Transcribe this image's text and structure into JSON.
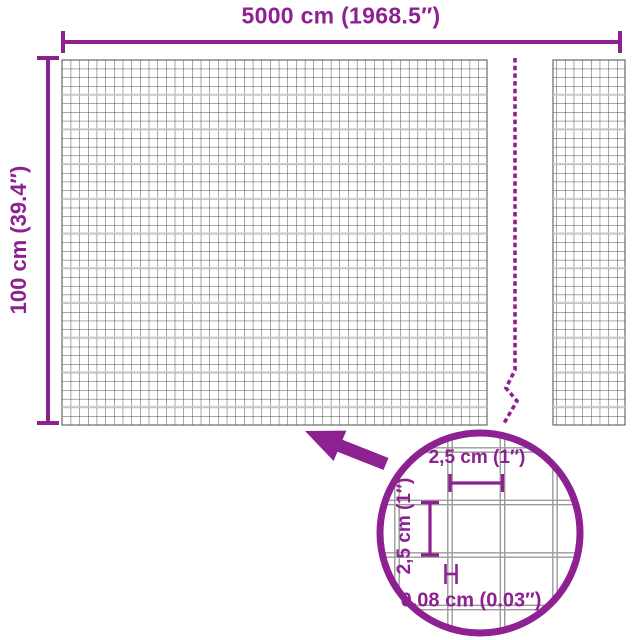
{
  "title": "Wire mesh panel dimensions diagram",
  "colors": {
    "accent_purple": "#8e2192",
    "mesh_line": "#4d4d4d",
    "wire_gray": "#9a9a9a",
    "background": "#ffffff"
  },
  "dimensions": {
    "width": {
      "label": "5000 cm (1968.5″)"
    },
    "height": {
      "label": "100 cm (39.4″)"
    }
  },
  "detail_inset": {
    "mesh_width": {
      "label": "2,5 cm (1″)"
    },
    "mesh_height": {
      "label": "2,5 cm (1″)"
    },
    "wire_thickness": {
      "label": "0,08 cm (0.03″)"
    }
  },
  "icons": {
    "zoom_arrow": "arrow-pointing-up-left-from-detail-circle",
    "break_line": "dashed-break-line"
  }
}
